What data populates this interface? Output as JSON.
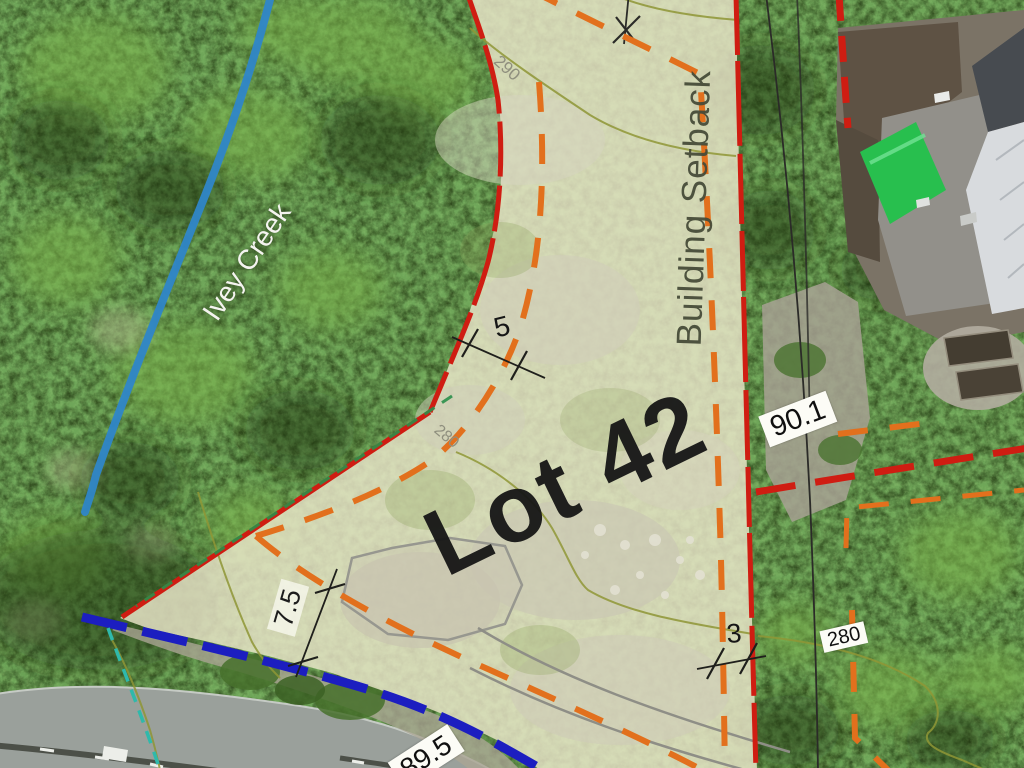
{
  "map": {
    "labels": {
      "lot": "Lot 42",
      "building_setback": "Building Setback",
      "creek": "Ivey Creek"
    },
    "contour_labels": {
      "c290": "290",
      "c280_mid": "280",
      "c280_right": "280"
    },
    "dimensions": {
      "setback_west": "5",
      "road_setback": "7.5",
      "setback_east": "3",
      "boundary_east_length": "90.1",
      "frontage_length": "89.5"
    },
    "colors": {
      "boundary_red": "#cf1d12",
      "setback_orange": "#e2701d",
      "frontage_blue": "#1c1ec0",
      "creek_blue": "#2f86c8",
      "contour_olive": "#8f9636",
      "flagging_green": "#2a8f4a",
      "teal_dash": "#2fb9ab",
      "lot_fill": "#ebe7ca"
    }
  }
}
